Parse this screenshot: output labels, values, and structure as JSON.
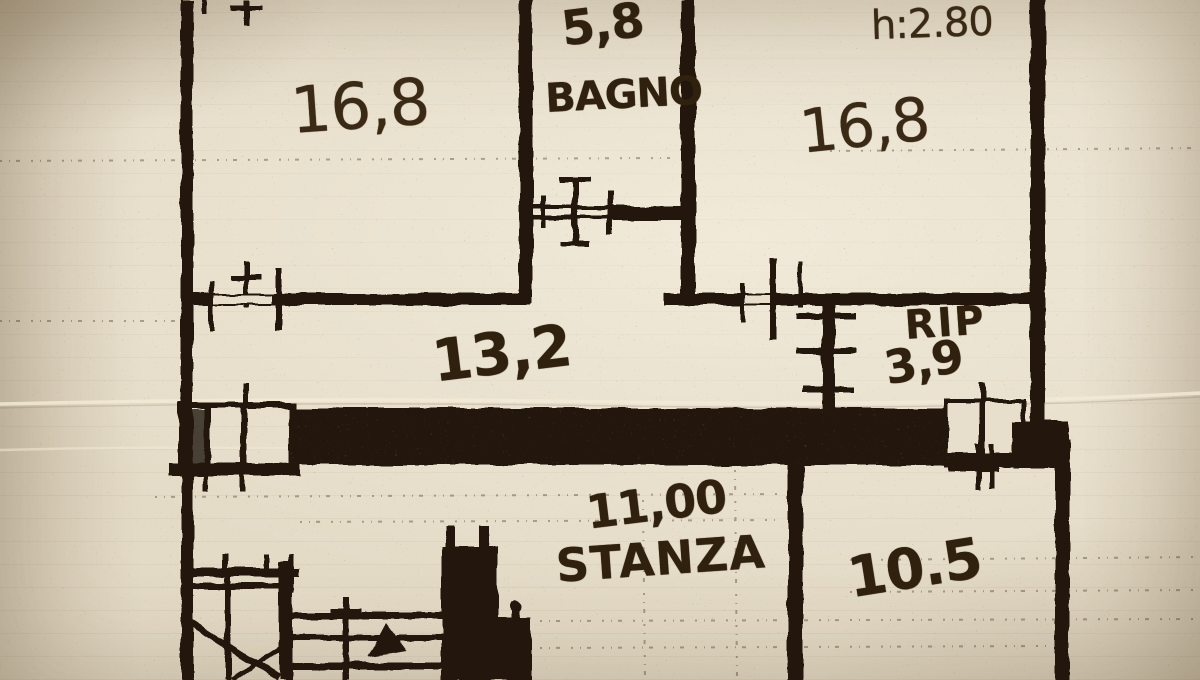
{
  "document": {
    "kind": "scanned hand-drawn floor plan",
    "language": "Italian"
  },
  "colors": {
    "paper": "#e4dbc7",
    "ink": "#211509",
    "pencil": "#3a2914"
  },
  "rooms": [
    {
      "id": "room-top-left",
      "area": "16,8"
    },
    {
      "id": "bagno",
      "area": "5,8",
      "label": "BAGNO"
    },
    {
      "id": "room-top-right",
      "area": "16,8",
      "height_note": "h:2.80"
    },
    {
      "id": "corridoio",
      "area": "13,2"
    },
    {
      "id": "ripostiglio",
      "area": "3,9",
      "label": "RIP"
    },
    {
      "id": "stanza",
      "area": "11,00",
      "label": "STANZA"
    },
    {
      "id": "room-bottom-right",
      "area": "10.5"
    }
  ]
}
